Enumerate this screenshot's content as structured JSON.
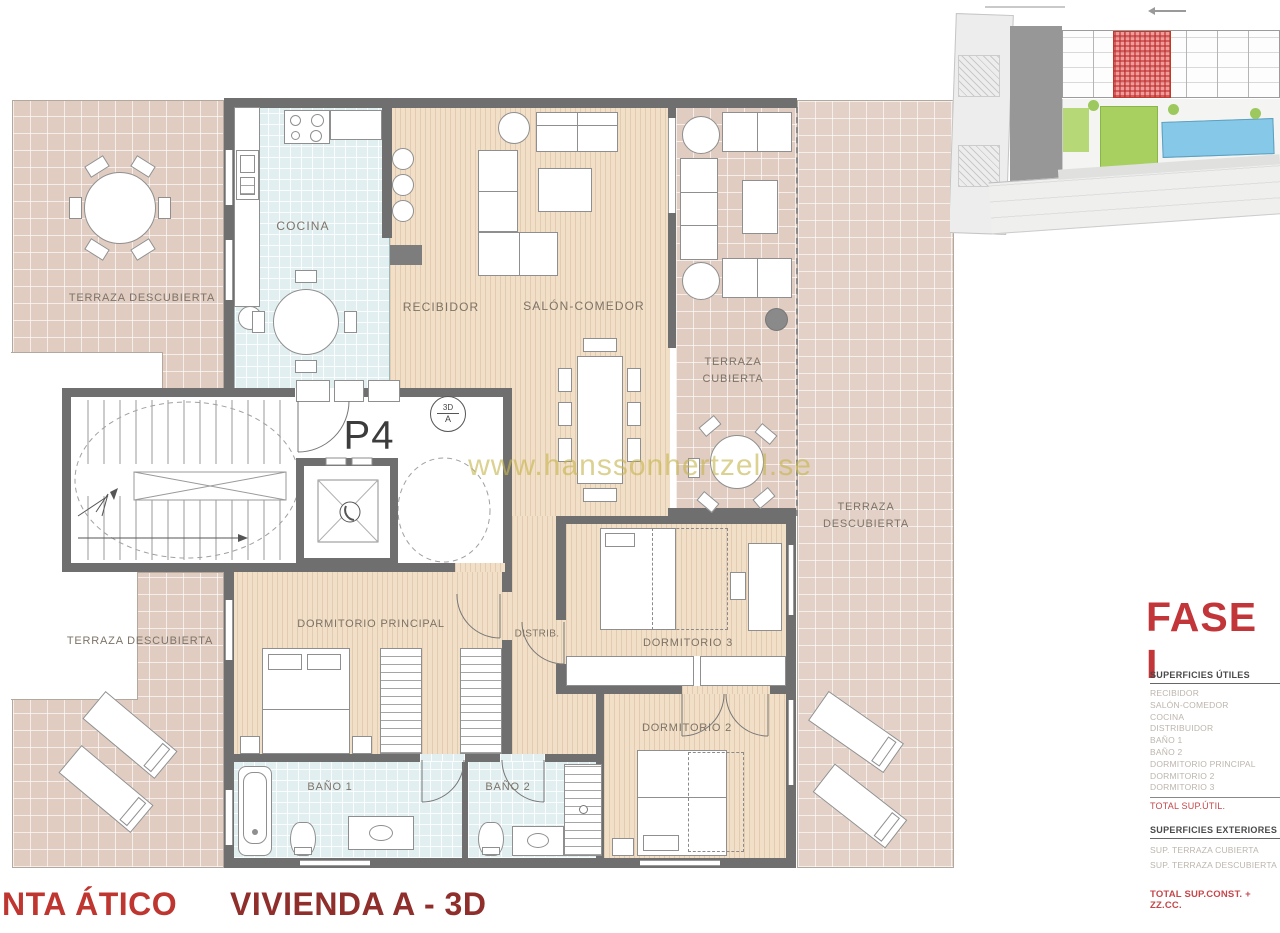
{
  "colors": {
    "wall_gray": "#6f6f6f",
    "terrace_tile": "#e0ccc1",
    "wood_floor": "#f1dfc7",
    "wet_room_tile": "#e2eff1",
    "accent_red": "#c2363a",
    "footer_red": "#bf3530",
    "footer_dark_red": "#8f2e2b",
    "label_gray": "#7d7367",
    "watermark_gold": "#c6b64e",
    "site_highlight_red": "#d9534f",
    "site_pool_blue": "#86c8e8",
    "site_green": "#a8d060"
  },
  "watermark": {
    "text": "www.hanssonhertzell.se"
  },
  "floor_plan": {
    "unit_label": "P4",
    "view_marker": {
      "top": "3D",
      "bottom": "A"
    },
    "rooms": {
      "terraza_descubierta_top": "TERRAZA DESCUBIERTA",
      "cocina": "COCINA",
      "recibidor": "RECIBIDOR",
      "salon_comedor": "SALÓN-COMEDOR",
      "terraza_cubierta": "TERRAZA CUBIERTA",
      "terraza_descubierta_right": "TERRAZA DESCUBIERTA",
      "terraza_descubierta_bottom": "TERRAZA DESCUBIERTA",
      "dormitorio_principal": "DORMITORIO PRINCIPAL",
      "distribuidor": "DISTRIB.",
      "dormitorio_3": "DORMITORIO 3",
      "dormitorio_2": "DORMITORIO 2",
      "bano_1": "BAÑO 1",
      "bano_2": "BAÑO 2"
    }
  },
  "side_panel": {
    "phase_title": "FASE I",
    "superficies_utiles": {
      "heading": "SUPERFICIES ÚTILES",
      "items": [
        "RECIBIDOR",
        "SALÓN-COMEDOR",
        "COCINA",
        "DISTRIBUIDOR",
        "BAÑO 1",
        "BAÑO 2",
        "DORMITORIO PRINCIPAL",
        "DORMITORIO 2",
        "DORMITORIO 3"
      ],
      "total_label": "TOTAL SUP.ÚTIL."
    },
    "superficies_exteriores": {
      "heading": "SUPERFICIES EXTERIORES",
      "items": [
        "SUP. TERRAZA CUBIERTA",
        "SUP. TERRAZA DESCUBIERTA"
      ],
      "total_label": "TOTAL SUP.CONST. + ZZ.CC."
    }
  },
  "footer": {
    "plan_title": "NTA ÁTICO",
    "unit_title": "VIVIENDA A - 3D"
  }
}
